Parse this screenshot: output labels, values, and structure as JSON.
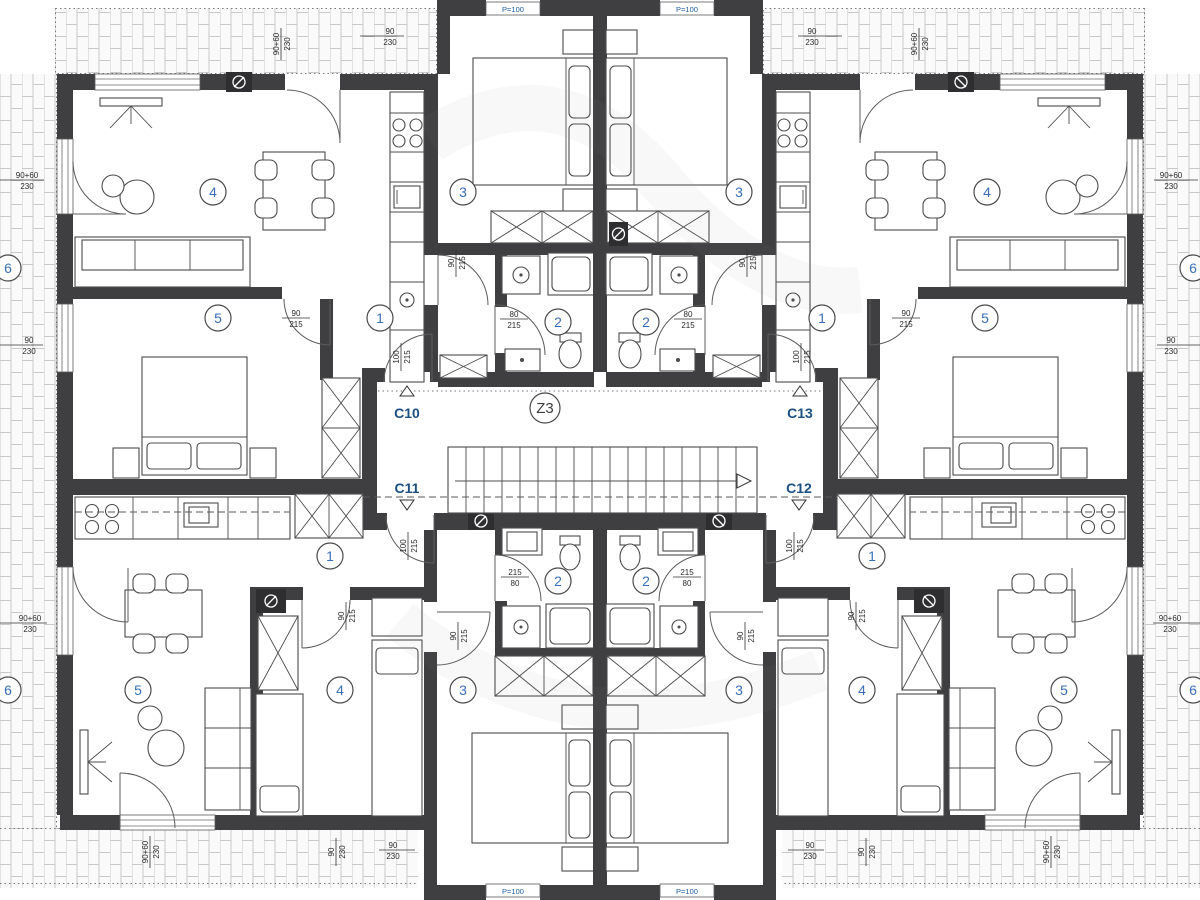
{
  "title": "apartment-building-floor-plan",
  "colors": {
    "wall": "#3f3f41",
    "room_number": "#3a6fb8",
    "section_marker": "#1b4f82",
    "hatch_line": "#c9c9c9"
  },
  "stair": {
    "label": "Z3"
  },
  "markers": {
    "c10": "C10",
    "c11": "C11",
    "c12": "C12",
    "c13": "C13"
  },
  "window_parapet": "P=100",
  "rooms": {
    "n1": "1",
    "n2": "2",
    "n3": "3",
    "n4": "4",
    "n5": "5",
    "n6": "6"
  },
  "dims": {
    "win90": {
      "t": "90",
      "b": "230"
    },
    "win9060": {
      "t": "90+60",
      "b": "230"
    },
    "door100": {
      "t": "100",
      "b": "215"
    },
    "door90": {
      "t": "90",
      "b": "215"
    },
    "door80": {
      "t": "80",
      "b": "215"
    },
    "door80r": {
      "t": "215",
      "b": "80"
    }
  }
}
